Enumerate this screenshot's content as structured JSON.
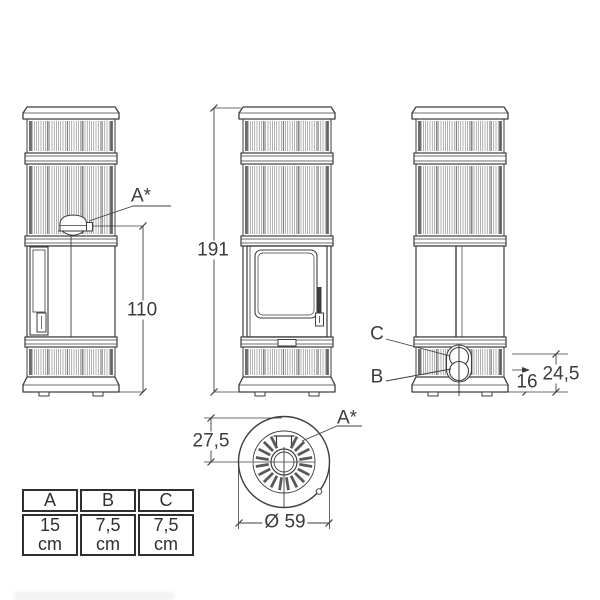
{
  "labels": {
    "total_height": "191",
    "outlet_height": "110",
    "rear_upper_offset": "24,5",
    "rear_lower_offset": "16",
    "top_outlet_offset": "27,5",
    "diameter": "Ø 59",
    "outlet_side": "A*",
    "outlet_top": "A*",
    "connection_b": "B",
    "connection_c": "C"
  },
  "table": {
    "headers": [
      "A",
      "B",
      "C"
    ],
    "values": [
      "15 cm",
      "7,5 cm",
      "7,5 cm"
    ]
  },
  "colors": {
    "line": "#3d3d3d",
    "text": "#3b3b3b",
    "background": "#ffffff"
  }
}
